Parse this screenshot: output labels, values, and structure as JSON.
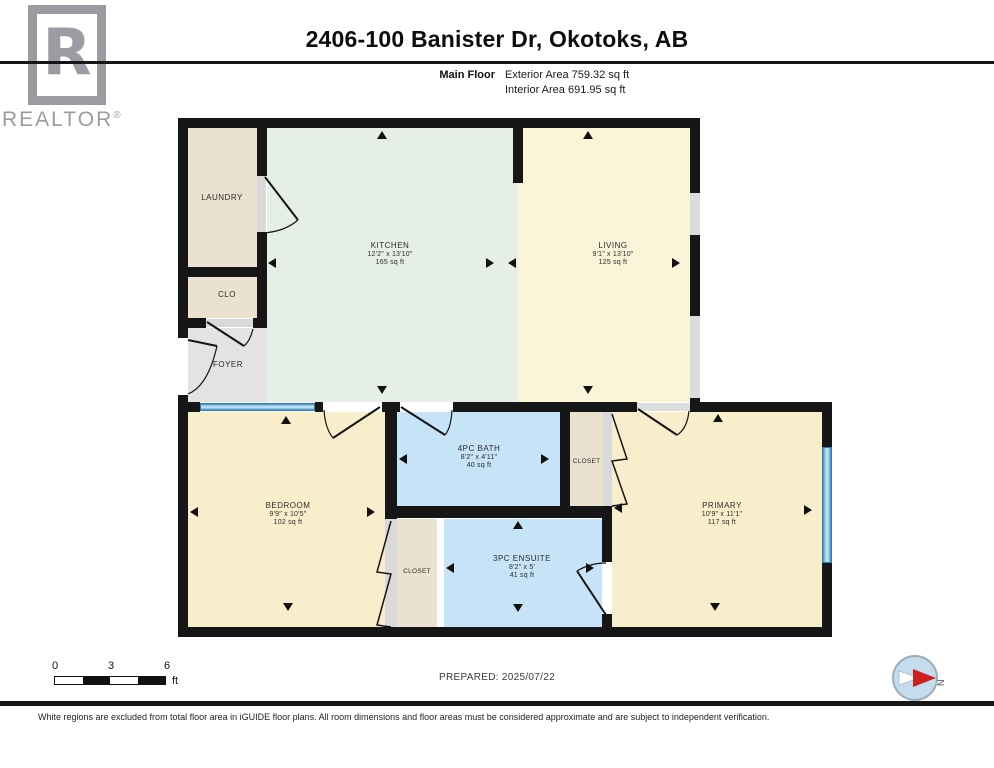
{
  "header": {
    "title": "2406-100 Banister Dr, Okotoks, AB",
    "floor_label": "Main Floor",
    "exterior_area": "Exterior Area 759.32 sq ft",
    "interior_area": "Interior Area 691.95 sq ft"
  },
  "logo": {
    "letter": "R",
    "word": "REALTOR",
    "reg": "®",
    "color": "#9b9ba2"
  },
  "rooms": {
    "laundry": {
      "label": "LAUNDRY"
    },
    "clo": {
      "label": "CLO"
    },
    "foyer": {
      "label": "FOYER"
    },
    "kitchen": {
      "label": "KITCHEN",
      "dims": "12'2\" x 13'10\"",
      "area": "165 sq ft"
    },
    "living": {
      "label": "LIVING",
      "dims": "9'1\" x 13'10\"",
      "area": "125 sq ft"
    },
    "bedroom": {
      "label": "BEDROOM",
      "dims": "9'9\" x 10'5\"",
      "area": "102 sq ft"
    },
    "bath": {
      "label": "4PC BATH",
      "dims": "8'2\" x 4'11\"",
      "area": "40 sq ft"
    },
    "bath_closet": {
      "label": "CLOSET"
    },
    "bedroom_closet": {
      "label": "CLOSET"
    },
    "ensuite": {
      "label": "3PC ENSUITE",
      "dims": "8'2\" x 5'",
      "area": "41 sq ft"
    },
    "primary": {
      "label": "PRIMARY",
      "dims": "10'9\" x 11'1\"",
      "area": "117 sq ft"
    }
  },
  "colors": {
    "wall": "#161616",
    "kitchen": "#e6efe7",
    "living": "#faf4d9",
    "bedroom": "#f8eecb",
    "bath": "#c6e3f7",
    "closet_beige": "#eae1cf",
    "foyer_gray": "#e3e3e1",
    "window_blue": "#4aa0d6"
  },
  "footer": {
    "scale_ticks": [
      "0",
      "3",
      "6"
    ],
    "scale_unit": "ft",
    "prepared": "PREPARED: 2025/07/22",
    "compass_label": "N",
    "disclaimer": "White regions are excluded from total floor area in iGUIDE floor plans. All room dimensions and floor areas must be considered approximate and are subject to independent verification."
  }
}
